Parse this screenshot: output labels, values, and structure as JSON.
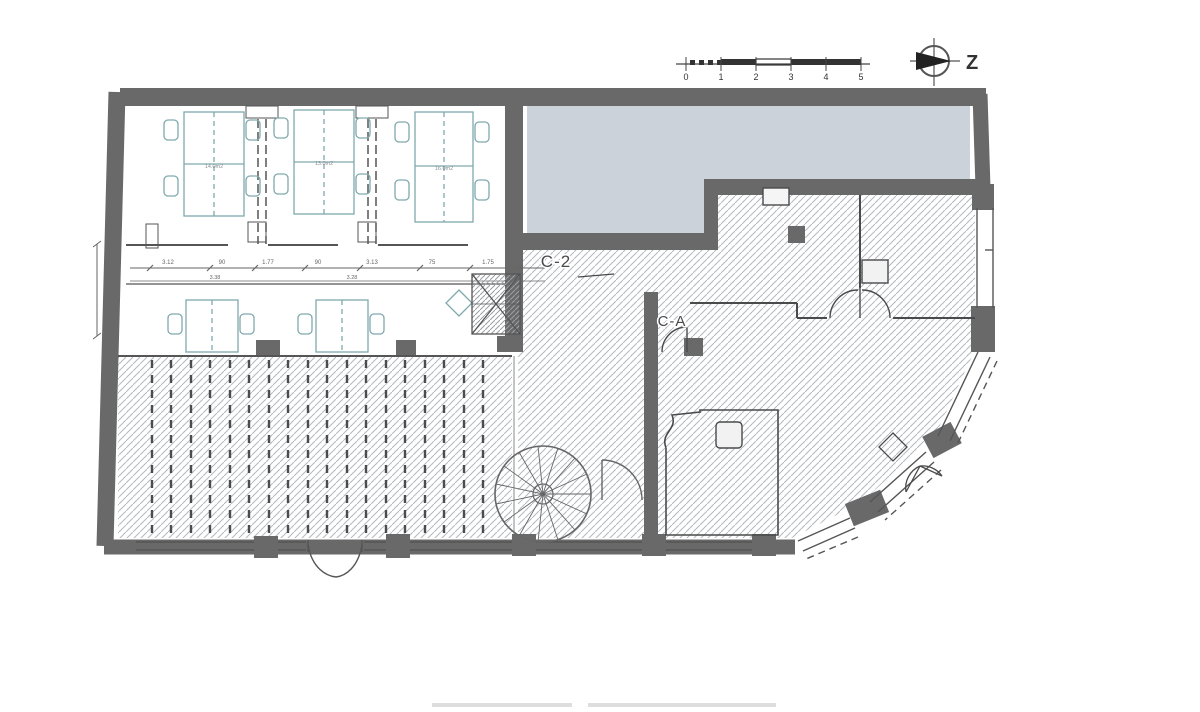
{
  "compass": {
    "label": "Z"
  },
  "scale_bar": {
    "ticks": [
      "0",
      "1",
      "2",
      "3",
      "4",
      "5"
    ]
  },
  "plan": {
    "section_labels": {
      "c2": "C-2",
      "ca": "C-A"
    },
    "room_labels": [
      {
        "label": "14.0m2"
      },
      {
        "label": "13.0m2"
      },
      {
        "label": "16.0m2"
      }
    ],
    "dimension_texts": {
      "row1": [
        "3.12",
        "90",
        "1.77",
        "90",
        "3.13",
        "75",
        "1.75"
      ],
      "row2": [
        "3.38",
        "3.28"
      ]
    },
    "colors": {
      "wall": "#696969",
      "shaded_area": "#ccd2d9",
      "hatch_line": "#b3b8bf",
      "furniture": "#7fa9ad",
      "line": "#4a4a4a"
    }
  }
}
